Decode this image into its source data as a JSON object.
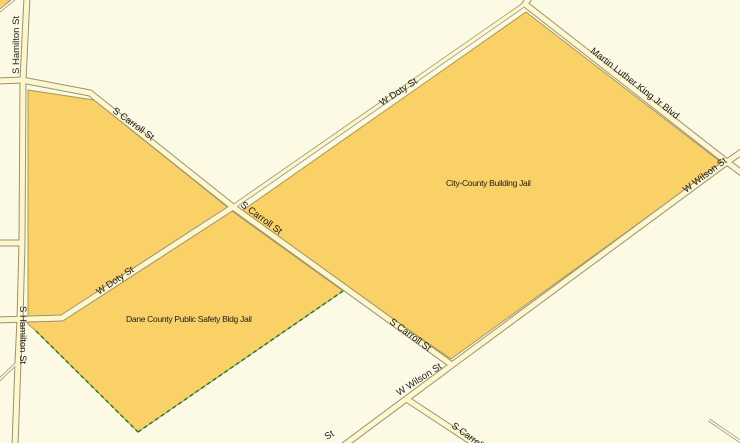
{
  "map": {
    "type": "gis-parcel-map",
    "colors": {
      "background": "#FCFAE4",
      "parcel_fill": "#FAD166",
      "parcel_outline": "#A89858",
      "road_fill": "#FDF7CB",
      "road_casing": "#99917A",
      "minor_road_casing": "#8F8F8F",
      "boundary_green": "#227D22",
      "label_text": "#1C1C1C"
    },
    "parcels": [
      {
        "name": "City-County Building Jail"
      },
      {
        "name": "Dane County Public Safety Bldg Jail"
      }
    ],
    "streets": [
      "S Hamilton St",
      "S Carroll St",
      "W Doty St",
      "Martin Luther King Jr Blvd",
      "W Wilson St"
    ],
    "labels": {
      "hamilton_top": "S Hamilton St",
      "hamilton_bottom": "S Hamilton St",
      "carroll_upper": "S Carroll St",
      "carroll_mid": "S Carroll St",
      "carroll_lower": "S Carroll St",
      "carroll_clipped": "S Carroll St",
      "doty_west": "W Doty St",
      "doty_east": "W Doty St",
      "mlk": "Martin Luther King Jr Blvd",
      "wilson_east": "W Wilson St",
      "wilson_mid": "W Wilson St",
      "wilson_fragment": "St",
      "parcel_city_county": "City-County Building Jail",
      "parcel_dane_county": "Dane County Public Safety Bldg Jail"
    }
  }
}
